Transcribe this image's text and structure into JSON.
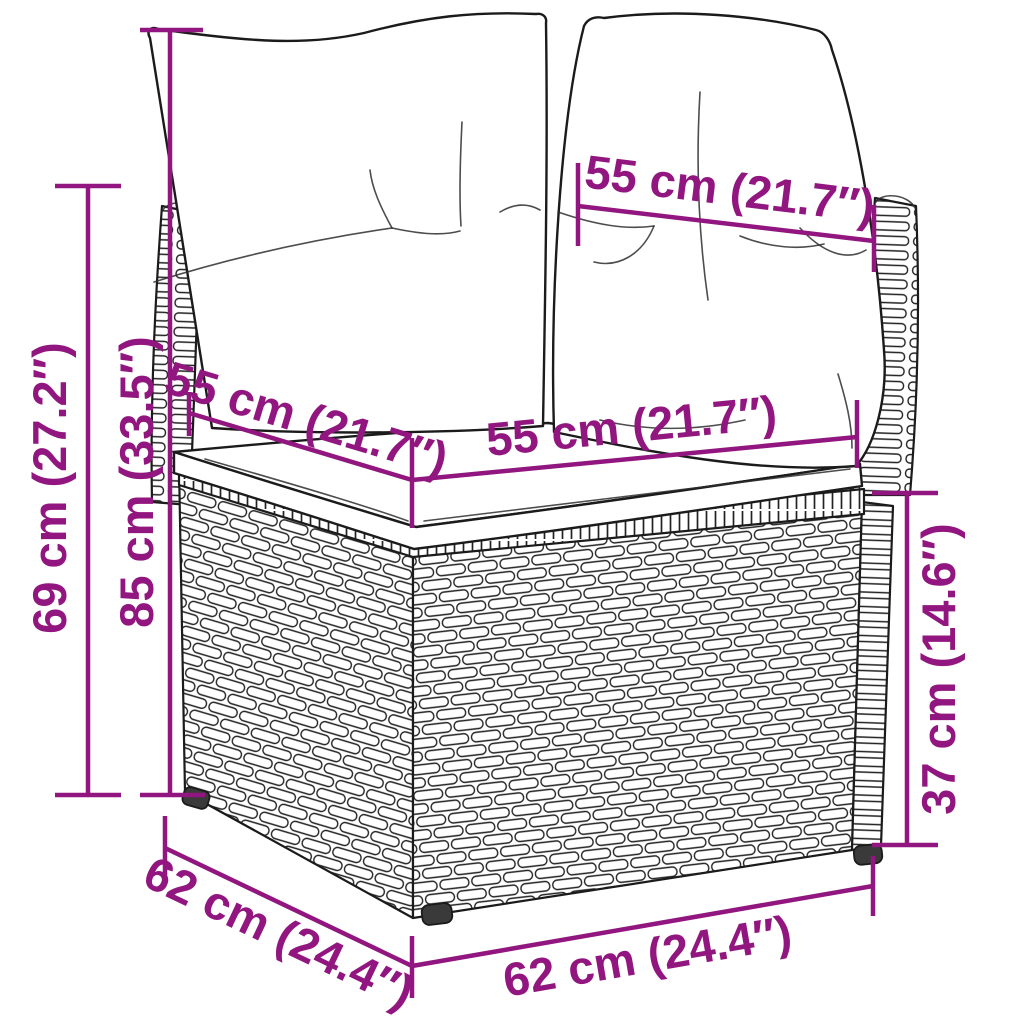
{
  "diagram": {
    "kind": "product-dimension-drawing",
    "subject": "rattan corner sofa section with back and seat cushions",
    "background_color": "#ffffff",
    "accent_color": "#92167F",
    "drawing_color": "#1b1b1b",
    "dimensions": {
      "back_cushion_width": {
        "text": "55 cm (21.7″)",
        "value_cm": 55,
        "value_in": 21.7,
        "orientation": "diagonal-top"
      },
      "total_height": {
        "text": "85 cm (33.5″)",
        "value_cm": 85,
        "value_in": 33.5,
        "orientation": "vertical-left"
      },
      "backrest_height": {
        "text": "69 cm (27.2″)",
        "value_cm": 69,
        "value_in": 27.2,
        "orientation": "vertical-far-left"
      },
      "seat_depth": {
        "text": "55 cm (21.7″)",
        "value_cm": 55,
        "value_in": 21.7,
        "orientation": "diagonal-left-seat"
      },
      "seat_width": {
        "text": "55 cm (21.7″)",
        "value_cm": 55,
        "value_in": 21.7,
        "orientation": "horizontal-seat-front"
      },
      "base_height": {
        "text": "37 cm (14.6″)",
        "value_cm": 37,
        "value_in": 14.6,
        "orientation": "vertical-right"
      },
      "base_depth": {
        "text": "62 cm (24.4″)",
        "value_cm": 62,
        "value_in": 24.4,
        "orientation": "diagonal-bottom-left"
      },
      "base_width": {
        "text": "62 cm (24.4″)",
        "value_cm": 62,
        "value_in": 24.4,
        "orientation": "horizontal-bottom"
      }
    }
  }
}
